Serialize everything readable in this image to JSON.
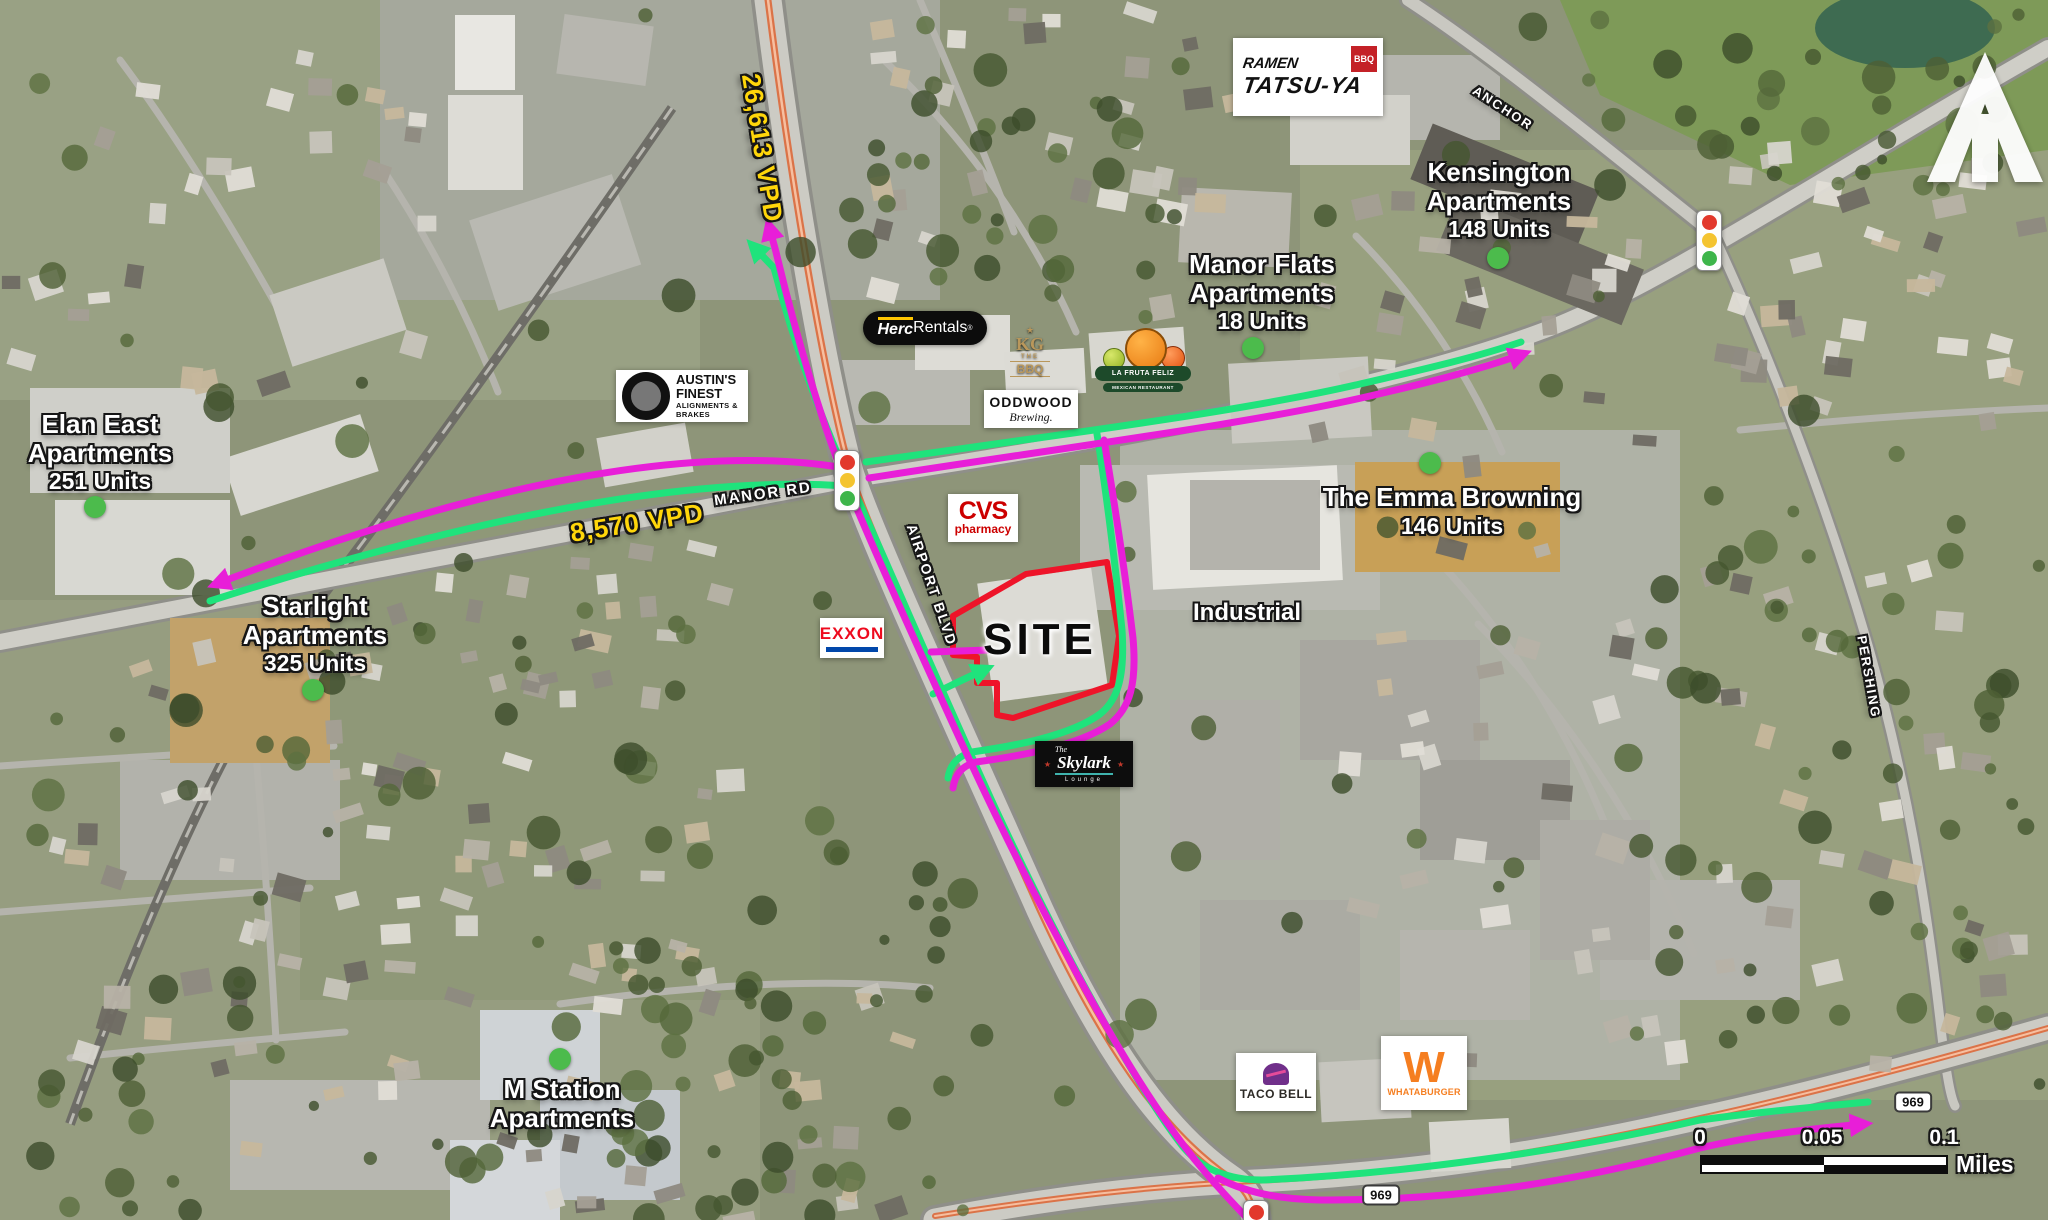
{
  "map": {
    "site": "SITE",
    "industrial": "Industrial"
  },
  "traffic_counts": {
    "airport_blvd": "26,613 VPD",
    "manor_rd": "8,570 VPD"
  },
  "road_labels": {
    "manor": "MANOR RD",
    "airport": "AIRPORT BLVD",
    "anchor": "ANCHOR",
    "pershing": "PERSHING",
    "route_969": "969"
  },
  "apartments": [
    {
      "line1": "Elan East",
      "line2": "Apartments",
      "units": "251 Units"
    },
    {
      "line1": "Starlight",
      "line2": "Apartments",
      "units": "325 Units"
    },
    {
      "line1": "M Station",
      "line2": "Apartments"
    },
    {
      "line1": "Manor Flats",
      "line2": "Apartments",
      "units": "18 Units"
    },
    {
      "line1": "Kensington",
      "line2": "Apartments",
      "units": "148 Units"
    },
    {
      "line1": "The Emma Browning",
      "units": "146 Units"
    }
  ],
  "businesses": {
    "ramen_tatsuya": {
      "line1": "RAMEN",
      "line2": "TATSU-YA",
      "badge": "BBQ"
    },
    "herc_rentals": {
      "part1": "Herc",
      "part2": "Rentals",
      "reg": "®"
    },
    "austins_finest": {
      "line1": "AUSTIN'S FINEST",
      "line2": "ALIGNMENTS & BRAKES"
    },
    "kg_bbq": {
      "star": "★",
      "monogram": "KG",
      "mid": "THE",
      "bottom": "BBQ"
    },
    "oddwood": {
      "line1": "ODDWOOD",
      "line2": "Brewing."
    },
    "la_fruta_feliz": {
      "line1": "LA FRUTA FELIZ",
      "line2": "MEXICAN RESTAURANT"
    },
    "cvs": {
      "line1": "CVS",
      "line2": "pharmacy"
    },
    "exxon": {
      "name": "EXXON"
    },
    "skylark": {
      "pre": "The",
      "name": "Skylark",
      "sub": "Lounge"
    },
    "taco_bell": {
      "name": "TACO BELL"
    },
    "whataburger": {
      "initial": "W",
      "name": "WHATABURGER"
    }
  },
  "scale_bar": {
    "start": "0",
    "mid": "0.05",
    "end": "0.1",
    "unit": "Miles"
  },
  "colors": {
    "route_green": "#1FE37C",
    "route_magenta": "#E81ED8",
    "site_outline_red": "#EE1429",
    "vpd_yellow": "#FFD60A",
    "marker_green": "#4CBB4C"
  }
}
